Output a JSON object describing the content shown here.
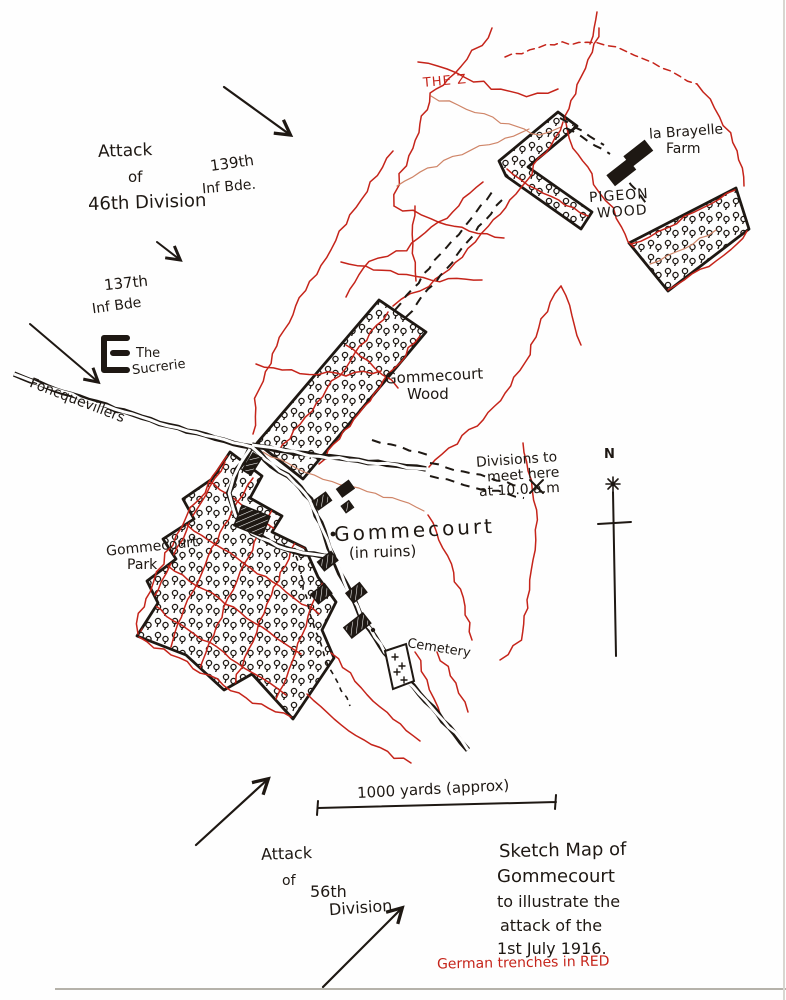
{
  "colors": {
    "ink": "#1e1813",
    "trench": "#c5241a",
    "trenchLight": "#cf8568",
    "paper": "#fefefe"
  },
  "labels": {
    "attack46": {
      "l1": "Attack",
      "l2": "of",
      "l3": "46th Division"
    },
    "bde139": {
      "l1": "139th",
      "l2": "Inf Bde."
    },
    "bde137": {
      "l1": "137th",
      "l2": "Inf Bde"
    },
    "sucrerie": {
      "l1": "The",
      "l2": "Sucrerie"
    },
    "foncquevillers": "– Foncquevillers",
    "theZ": "THE Z",
    "brayelle": {
      "l1": "la Brayelle",
      "l2": "Farm"
    },
    "pigeon": {
      "l1": "PIGEON",
      "l2": "WOOD"
    },
    "gwood": {
      "l1": "Gommecourt",
      "l2": "Wood"
    },
    "meet": {
      "l1": "Divisions to",
      "l2": "meet here",
      "l3": "at 10.0 a.m"
    },
    "north": "N",
    "gommecourt": {
      "l1": "Gommecourt",
      "l2": "(in ruins)"
    },
    "gpark": {
      "l1": "Gommecourt",
      "l2": "Park"
    },
    "cemetery": "Cemetery",
    "scale": "1000 yards (approx)",
    "attack56": {
      "l1": "Attack",
      "l2": "of",
      "l3": "56th",
      "l4": "Division"
    },
    "caption": {
      "l1": "Sketch Map of",
      "l2": "Gommecourt",
      "l3": "to illustrate the",
      "l4": "attack of the",
      "l5": "1st July 1916."
    },
    "legend": "German trenches in RED"
  }
}
